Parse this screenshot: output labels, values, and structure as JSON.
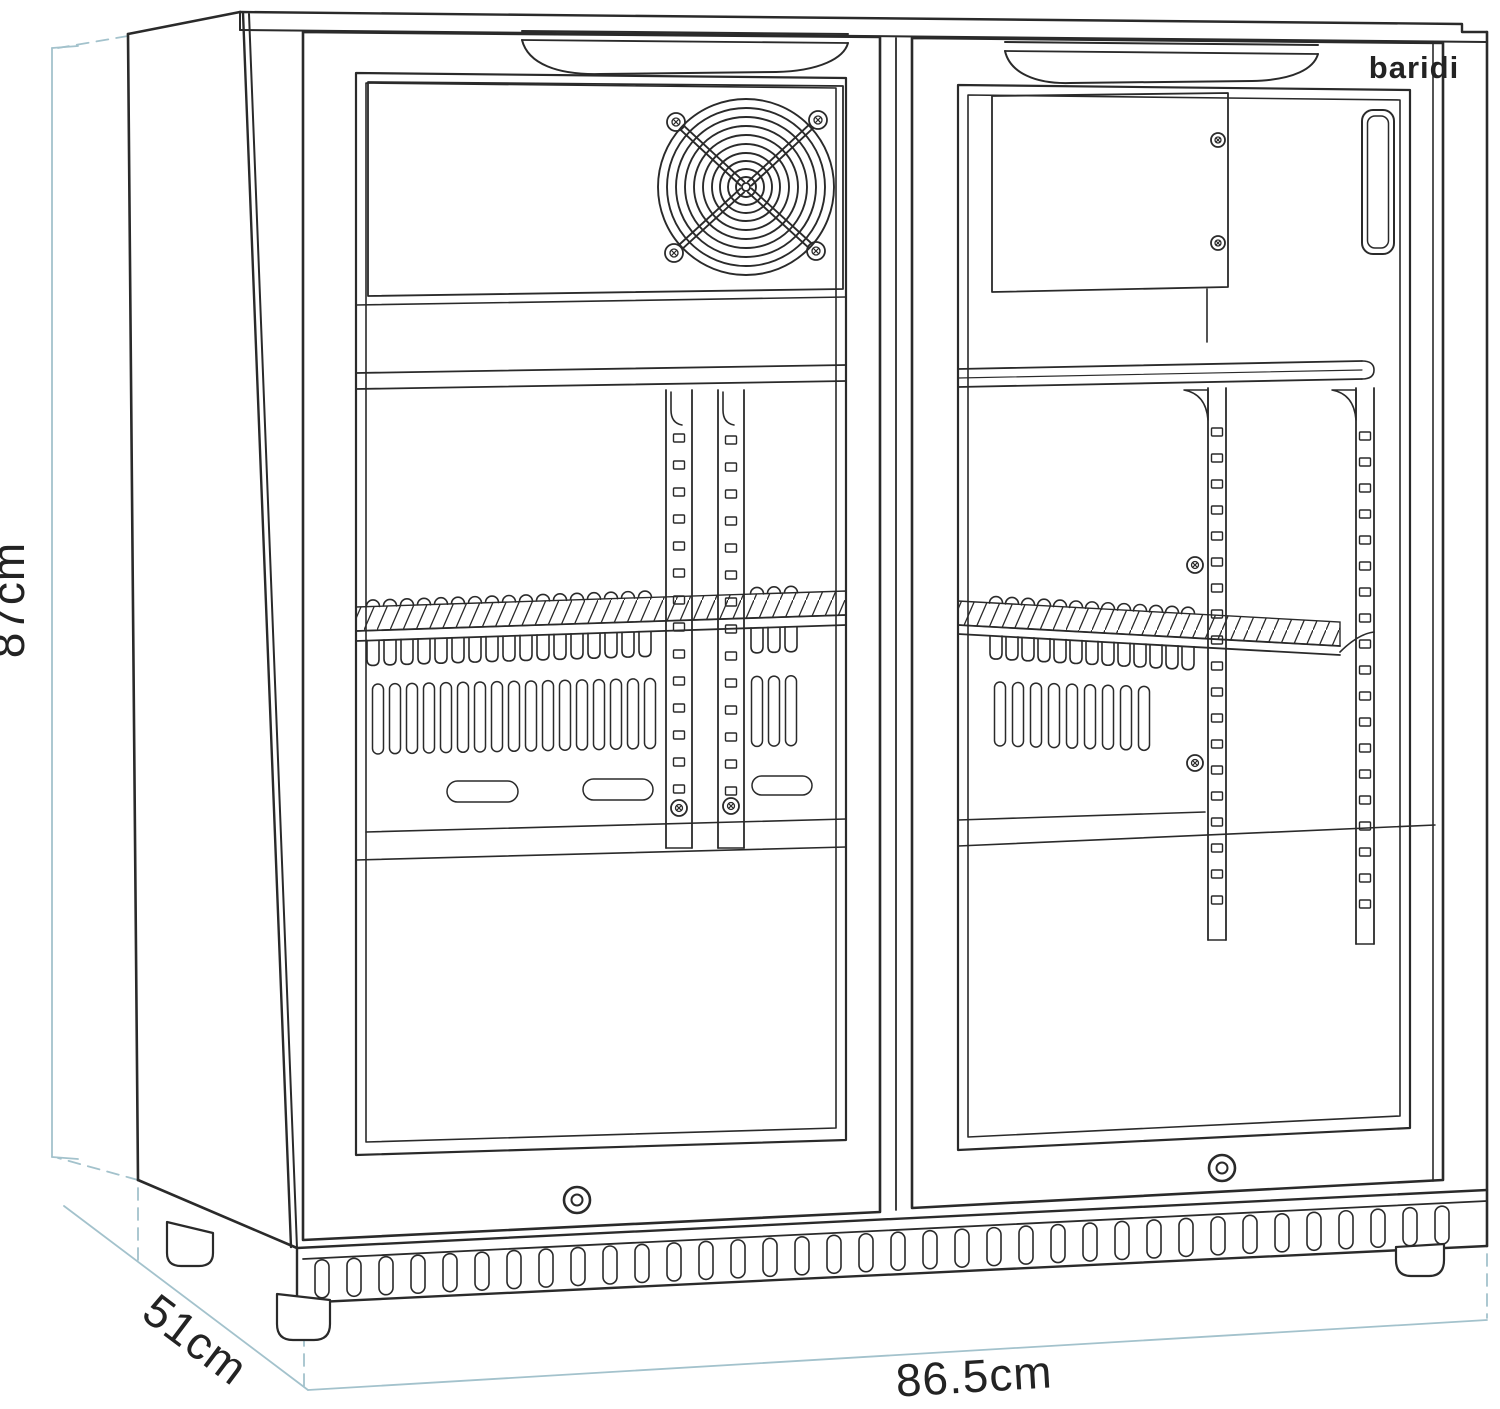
{
  "title": "Fridge dimensions diagram",
  "brand": {
    "logo_text": "baridi"
  },
  "dimensions": {
    "height_label": "87cm",
    "depth_label": "51cm",
    "width_label": "86.5cm"
  },
  "colors": {
    "outline": "#2a2a2a",
    "dimension_line": "#a3c2cc",
    "label_text": "#232323",
    "background": "#ffffff"
  }
}
